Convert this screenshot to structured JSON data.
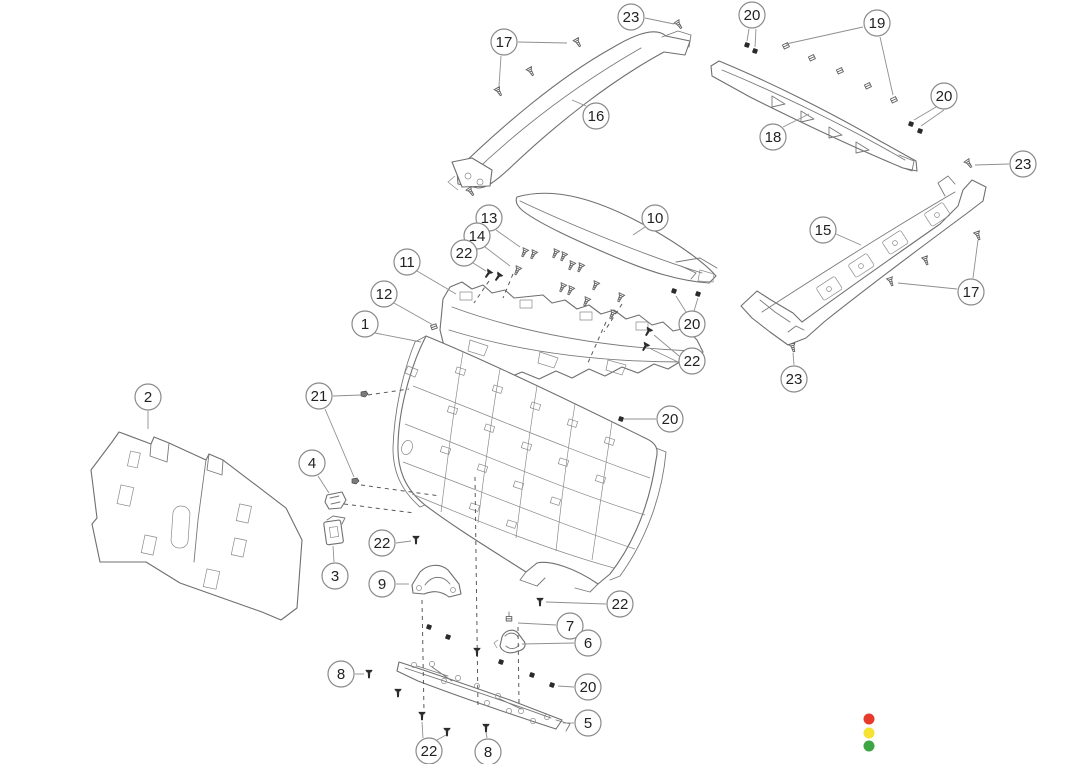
{
  "diagram": {
    "title": "exploded-parts-diagram-liftgate-trim",
    "colors": {
      "background": "#ffffff",
      "line": "#6f6f6f",
      "leader": "#8f8f8f",
      "callout_stroke": "#8a8a8a",
      "callout_fill": "#ffffff",
      "callout_text": "#222222",
      "fastener_dark": "#2b2b2b",
      "legend_red": "#e83a2b",
      "legend_yellow": "#f6e233",
      "legend_green": "#3ea544"
    },
    "callout_radius": 13,
    "callouts": [
      {
        "label": "23",
        "x": 631,
        "y": 17,
        "leaders": [
          [
            645,
            18,
            674,
            24
          ]
        ]
      },
      {
        "label": "17",
        "x": 504,
        "y": 42,
        "leaders": [
          [
            518,
            42,
            567,
            43
          ],
          [
            501,
            56,
            499,
            86
          ]
        ]
      },
      {
        "label": "16",
        "x": 596,
        "y": 116,
        "leaders": [
          [
            586,
            106,
            572,
            100
          ]
        ]
      },
      {
        "label": "20",
        "x": 752,
        "y": 15,
        "leaders": [
          [
            749,
            29,
            747,
            41
          ],
          [
            756,
            29,
            755,
            47
          ]
        ]
      },
      {
        "label": "19",
        "x": 877,
        "y": 23,
        "leaders": [
          [
            863,
            27,
            786,
            44
          ],
          [
            880,
            37,
            893,
            95
          ]
        ]
      },
      {
        "label": "20",
        "x": 944,
        "y": 96,
        "leaders": [
          [
            936,
            107,
            914,
            120
          ],
          [
            944,
            110,
            921,
            126
          ]
        ]
      },
      {
        "label": "23",
        "x": 1023,
        "y": 164,
        "leaders": [
          [
            1009,
            164,
            975,
            165
          ]
        ]
      },
      {
        "label": "18",
        "x": 773,
        "y": 137,
        "leaders": [
          [
            783,
            127,
            809,
            114
          ]
        ]
      },
      {
        "label": "15",
        "x": 823,
        "y": 230,
        "leaders": [
          [
            836,
            234,
            861,
            245
          ]
        ]
      },
      {
        "label": "17",
        "x": 971,
        "y": 292,
        "leaders": [
          [
            973,
            278,
            978,
            240
          ],
          [
            957,
            289,
            898,
            283
          ]
        ]
      },
      {
        "label": "23",
        "x": 794,
        "y": 379,
        "leaders": [
          [
            794,
            365,
            793,
            353
          ]
        ]
      },
      {
        "label": "10",
        "x": 655,
        "y": 218,
        "leaders": [
          [
            645,
            227,
            633,
            235
          ]
        ]
      },
      {
        "label": "13",
        "x": 489,
        "y": 218,
        "leaders": [
          [
            496,
            230,
            520,
            247
          ]
        ]
      },
      {
        "label": "14",
        "x": 477,
        "y": 236,
        "leaders": [
          [
            485,
            247,
            510,
            266
          ]
        ]
      },
      {
        "label": "22",
        "x": 464,
        "y": 253,
        "leaders": [
          [
            473,
            263,
            486,
            271
          ]
        ]
      },
      {
        "label": "11",
        "x": 407,
        "y": 262,
        "leaders": [
          [
            417,
            271,
            456,
            294
          ]
        ]
      },
      {
        "label": "12",
        "x": 384,
        "y": 294,
        "leaders": [
          [
            394,
            303,
            433,
            325
          ]
        ]
      },
      {
        "label": "1",
        "x": 365,
        "y": 324,
        "leaders": [
          [
            375,
            333,
            421,
            342
          ]
        ]
      },
      {
        "label": "20",
        "x": 692,
        "y": 324,
        "leaders": [
          [
            686,
            312,
            676,
            296
          ],
          [
            694,
            311,
            698,
            298
          ]
        ]
      },
      {
        "label": "22",
        "x": 692,
        "y": 361,
        "leaders": [
          [
            679,
            356,
            654,
            335
          ],
          [
            678,
            362,
            651,
            349
          ]
        ]
      },
      {
        "label": "21",
        "x": 319,
        "y": 396,
        "leaders": [
          [
            333,
            396,
            361,
            395
          ],
          [
            325,
            409,
            354,
            477
          ]
        ]
      },
      {
        "label": "20",
        "x": 670,
        "y": 419,
        "leaders": [
          [
            656,
            419,
            624,
            419
          ]
        ]
      },
      {
        "label": "2",
        "x": 148,
        "y": 397,
        "leaders": [
          [
            148,
            411,
            148,
            429
          ]
        ]
      },
      {
        "label": "4",
        "x": 312,
        "y": 463,
        "leaders": [
          [
            318,
            476,
            329,
            493
          ]
        ]
      },
      {
        "label": "3",
        "x": 335,
        "y": 576,
        "leaders": [
          [
            334,
            562,
            333,
            546
          ]
        ]
      },
      {
        "label": "22",
        "x": 382,
        "y": 543,
        "leaders": [
          [
            396,
            543,
            411,
            541
          ]
        ]
      },
      {
        "label": "9",
        "x": 382,
        "y": 584,
        "leaders": [
          [
            396,
            584,
            409,
            584
          ]
        ]
      },
      {
        "label": "22",
        "x": 620,
        "y": 604,
        "leaders": [
          [
            606,
            604,
            546,
            602
          ]
        ]
      },
      {
        "label": "7",
        "x": 570,
        "y": 626,
        "leaders": [
          [
            556,
            625,
            518,
            623
          ]
        ]
      },
      {
        "label": "6",
        "x": 588,
        "y": 643,
        "leaders": [
          [
            574,
            643,
            522,
            644
          ]
        ]
      },
      {
        "label": "8",
        "x": 341,
        "y": 674,
        "leaders": [
          [
            355,
            674,
            364,
            674
          ]
        ]
      },
      {
        "label": "20",
        "x": 588,
        "y": 687,
        "leaders": [
          [
            574,
            687,
            558,
            686
          ]
        ]
      },
      {
        "label": "5",
        "x": 588,
        "y": 723,
        "leaders": [
          [
            574,
            723,
            563,
            723
          ]
        ]
      },
      {
        "label": "22",
        "x": 429,
        "y": 751,
        "leaders": [
          [
            423,
            738,
            422,
            722
          ],
          [
            437,
            740,
            446,
            735
          ]
        ]
      },
      {
        "label": "8",
        "x": 488,
        "y": 752,
        "leaders": [
          [
            487,
            738,
            486,
            732
          ]
        ]
      }
    ],
    "fasteners": [
      {
        "type": "screw-light",
        "x": 679,
        "y": 25,
        "rot": -35
      },
      {
        "type": "screw-light",
        "x": 578,
        "y": 43,
        "rot": -30
      },
      {
        "type": "screw-light",
        "x": 531,
        "y": 72,
        "rot": -30
      },
      {
        "type": "screw-light",
        "x": 499,
        "y": 92,
        "rot": -30
      },
      {
        "type": "screw-light",
        "x": 471,
        "y": 192,
        "rot": -35
      },
      {
        "type": "screw-light",
        "x": 969,
        "y": 164,
        "rot": -35
      },
      {
        "type": "screw-light",
        "x": 978,
        "y": 236,
        "rot": -20
      },
      {
        "type": "screw-light",
        "x": 926,
        "y": 261,
        "rot": -20
      },
      {
        "type": "screw-light",
        "x": 891,
        "y": 282,
        "rot": -20
      },
      {
        "type": "screw-light",
        "x": 793,
        "y": 348,
        "rot": -15
      },
      {
        "type": "clip-light",
        "x": 786,
        "y": 46,
        "rot": -25
      },
      {
        "type": "clip-light",
        "x": 812,
        "y": 58,
        "rot": -25
      },
      {
        "type": "clip-light",
        "x": 840,
        "y": 71,
        "rot": -25
      },
      {
        "type": "clip-light",
        "x": 868,
        "y": 86,
        "rot": -25
      },
      {
        "type": "clip-light",
        "x": 894,
        "y": 100,
        "rot": -25
      },
      {
        "type": "clip-dark",
        "x": 747,
        "y": 45,
        "rot": 0
      },
      {
        "type": "clip-dark",
        "x": 755,
        "y": 51,
        "rot": 0
      },
      {
        "type": "clip-dark",
        "x": 911,
        "y": 124,
        "rot": 0
      },
      {
        "type": "clip-dark",
        "x": 920,
        "y": 131,
        "rot": 0
      },
      {
        "type": "screw-light",
        "x": 524,
        "y": 253,
        "rot": 25
      },
      {
        "type": "screw-light",
        "x": 533,
        "y": 255,
        "rot": 25
      },
      {
        "type": "screw-light",
        "x": 517,
        "y": 271,
        "rot": 25
      },
      {
        "type": "screw-light",
        "x": 555,
        "y": 254,
        "rot": 25
      },
      {
        "type": "screw-light",
        "x": 563,
        "y": 257,
        "rot": 25
      },
      {
        "type": "screw-light",
        "x": 571,
        "y": 266,
        "rot": 25
      },
      {
        "type": "screw-light",
        "x": 580,
        "y": 268,
        "rot": 25
      },
      {
        "type": "screw-light",
        "x": 562,
        "y": 288,
        "rot": 25
      },
      {
        "type": "screw-light",
        "x": 570,
        "y": 291,
        "rot": 25
      },
      {
        "type": "screw-light",
        "x": 595,
        "y": 286,
        "rot": 25
      },
      {
        "type": "screw-light",
        "x": 586,
        "y": 302,
        "rot": 25
      },
      {
        "type": "screw-light",
        "x": 620,
        "y": 298,
        "rot": 25
      },
      {
        "type": "screw-light",
        "x": 612,
        "y": 315,
        "rot": 25
      },
      {
        "type": "screw-dark",
        "x": 488,
        "y": 274,
        "rot": 35
      },
      {
        "type": "screw-dark",
        "x": 498,
        "y": 277,
        "rot": 35
      },
      {
        "type": "screw-dark",
        "x": 648,
        "y": 332,
        "rot": 30
      },
      {
        "type": "screw-dark",
        "x": 645,
        "y": 347,
        "rot": 30
      },
      {
        "type": "clip-dark",
        "x": 674,
        "y": 291,
        "rot": 0
      },
      {
        "type": "clip-dark",
        "x": 698,
        "y": 294,
        "rot": 0
      },
      {
        "type": "clip-dark",
        "x": 621,
        "y": 419,
        "rot": 0
      },
      {
        "type": "clip-mid",
        "x": 364,
        "y": 394,
        "rot": 0
      },
      {
        "type": "clip-mid",
        "x": 355,
        "y": 481,
        "rot": 0
      },
      {
        "type": "screw-dark",
        "x": 416,
        "y": 540,
        "rot": 0
      },
      {
        "type": "screw-dark",
        "x": 540,
        "y": 602,
        "rot": 0
      },
      {
        "type": "clip-dark",
        "x": 429,
        "y": 627,
        "rot": 0
      },
      {
        "type": "clip-dark",
        "x": 448,
        "y": 637,
        "rot": 0
      },
      {
        "type": "screw-dark",
        "x": 477,
        "y": 652,
        "rot": 0
      },
      {
        "type": "clip-dark",
        "x": 501,
        "y": 662,
        "rot": 0
      },
      {
        "type": "clip-dark",
        "x": 532,
        "y": 675,
        "rot": 0
      },
      {
        "type": "clip-dark",
        "x": 552,
        "y": 685,
        "rot": 0
      },
      {
        "type": "clip-light",
        "x": 509,
        "y": 619,
        "rot": 0
      },
      {
        "type": "screw-dark",
        "x": 369,
        "y": 674,
        "rot": 0
      },
      {
        "type": "screw-dark",
        "x": 398,
        "y": 693,
        "rot": 0
      },
      {
        "type": "screw-dark",
        "x": 422,
        "y": 716,
        "rot": 0
      },
      {
        "type": "screw-dark",
        "x": 447,
        "y": 732,
        "rot": 0
      },
      {
        "type": "screw-dark",
        "x": 486,
        "y": 728,
        "rot": 0
      },
      {
        "type": "clip-light",
        "x": 434,
        "y": 327,
        "rot": -20
      }
    ],
    "legend_dots": [
      {
        "name": "red-dot",
        "color": "#e83a2b",
        "x": 869,
        "y": 719,
        "r": 5.5
      },
      {
        "name": "yellow-dot",
        "color": "#f6e233",
        "x": 869,
        "y": 733,
        "r": 5.5
      },
      {
        "name": "green-dot",
        "color": "#3ea544",
        "x": 869,
        "y": 746,
        "r": 5.5
      }
    ]
  }
}
